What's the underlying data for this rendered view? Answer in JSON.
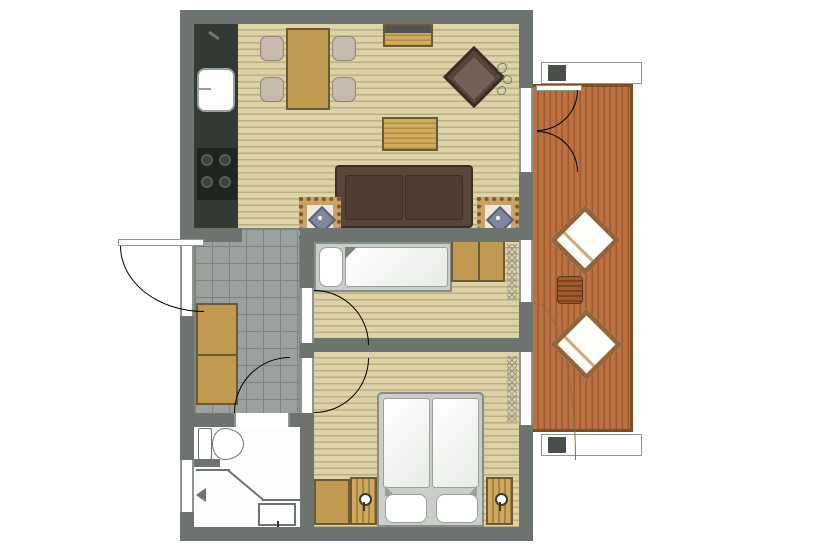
{
  "structure": {
    "type": "apartment-floor-plan",
    "rooms": [
      "kitchen-dining",
      "living-room",
      "hallway",
      "single-bedroom",
      "double-bedroom",
      "bathroom",
      "balcony"
    ]
  },
  "furniture": [
    "kitchen-counter",
    "kitchen-sink",
    "stove",
    "dining-table",
    "dining-chairs",
    "sideboard",
    "armchair",
    "coffee-table",
    "sofa",
    "mosaic-side-tables",
    "single-bed",
    "bedroom-wardrobe",
    "hallway-wardrobe",
    "double-bed",
    "nightstands",
    "bedroom-cabinet",
    "toilet",
    "shower",
    "lounge-chairs",
    "balcony-side-table",
    "potted-plant"
  ],
  "palette": {
    "wall": "#6d736e",
    "wall_dark": "#4a4f4a",
    "wood": "#ddd3a6",
    "wood_line": "#b9ae84",
    "tile": "#9ba19d",
    "tile_line": "#7d837e",
    "deck": "#bd7140",
    "deck_line": "#9a5a2d",
    "deck_border": "#7d4d24",
    "tan": "#c19a52",
    "tan_dark": "#6b5a33",
    "sofa": "#57453a",
    "sofa_dark": "#3a2d26",
    "cushion": "#4c3c31",
    "counter": "#313a33",
    "stove": "#1f2620",
    "chair": "#c6bbae",
    "chair_border": "#8d8477",
    "line": "#8f948e",
    "mosaic_bg": "#c8a268",
    "mosaic_dot": "#7a5a2e",
    "mosaic_center": "#8086a0",
    "bedframe": "#c9cec8",
    "plant": "#77806b"
  }
}
